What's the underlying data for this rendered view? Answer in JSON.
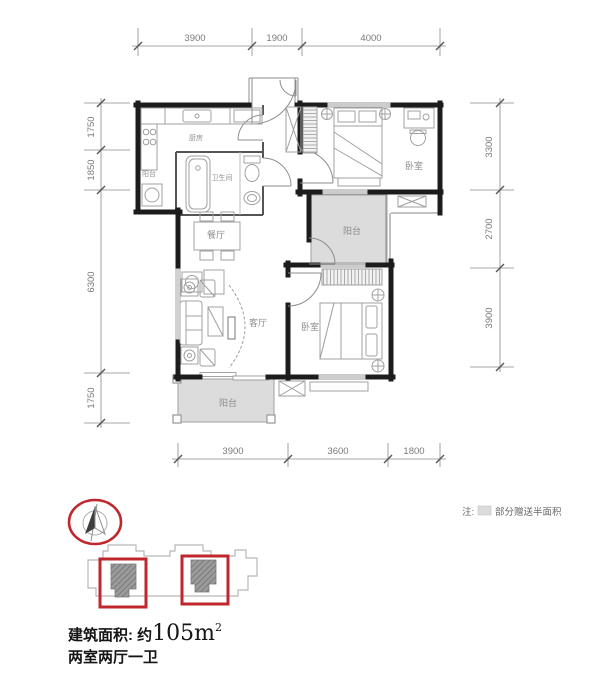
{
  "plan": {
    "room_labels": {
      "kitchen": "厨房",
      "bathroom": "卫生间",
      "balcony_left": "阳台",
      "bedroom_top": "卧室",
      "dining": "餐厅",
      "balcony_mid": "阳台",
      "living": "客厅",
      "bedroom_bottom": "卧室",
      "balcony_bottom": "阳台"
    },
    "dimensions": {
      "top": [
        "3900",
        "1900",
        "4000"
      ],
      "left": [
        "1750",
        "1850",
        "6300",
        "1750"
      ],
      "right": [
        "3300",
        "2700",
        "3900"
      ],
      "bottom": [
        "3900",
        "3600",
        "1800"
      ]
    }
  },
  "note": {
    "prefix": "注:",
    "text": "部分赠送半面积"
  },
  "summary": {
    "area_prefix": "建筑面积: 约",
    "area_value": "105m",
    "area_sup": "2",
    "layout": "两室两厅一卫"
  },
  "colors": {
    "wall": "#1c1c1c",
    "gift": "#dcdcdc",
    "red": "#c0272d",
    "furniture": "#a0a0a0",
    "label": "#8c8c8c",
    "dim": "#777777"
  }
}
